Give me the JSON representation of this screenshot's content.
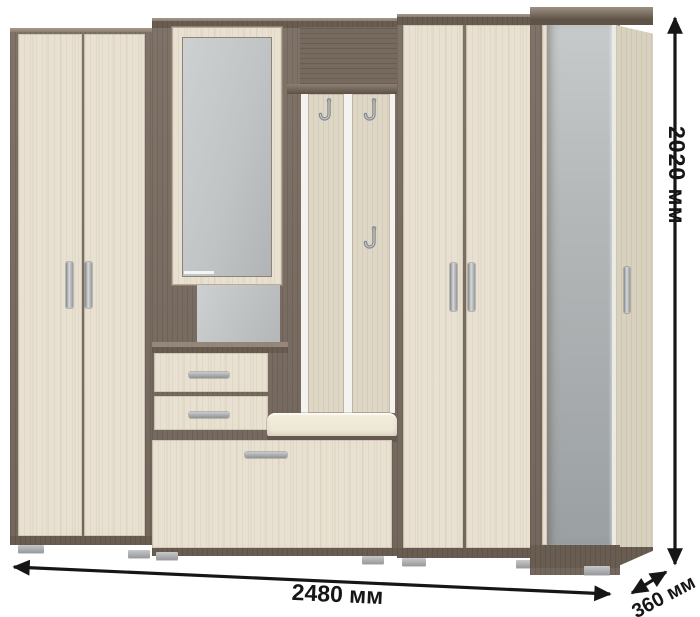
{
  "dimensions": {
    "width_label": "2480 мм",
    "height_label": "2020 мм",
    "depth_label": "360 мм"
  },
  "furniture": {
    "kind": "hallway furniture set",
    "sections": [
      {
        "name": "left wardrobe",
        "doors": 2,
        "handles": 2
      },
      {
        "name": "mirror cabinet with open shelf",
        "mirrors": 1
      },
      {
        "name": "drawer unit",
        "drawers": 2
      },
      {
        "name": "coat rack",
        "hooks": 3,
        "planks": 2
      },
      {
        "name": "bench with cushion",
        "cushions": 1
      },
      {
        "name": "shoe cabinet door",
        "doors": 1,
        "handles": 1
      },
      {
        "name": "right wardrobe",
        "doors": 2,
        "handles": 2
      },
      {
        "name": "tall mirror-door cabinet",
        "doors": 1,
        "handles": 1
      }
    ],
    "icons": {
      "coat_hook": "J-shaped metal hook",
      "door_handle": "vertical metal bar",
      "drawer_handle": "horizontal metal bow",
      "foot": "gray plastic block"
    }
  },
  "colors": {
    "wood_light": "#e8e1d1",
    "wood_plank": "#ded7c6",
    "wood_side": "#d8d1bf",
    "wood_dark": "#7a6d62",
    "wood_darker": "#695d52",
    "wood_deep": "#5a4f45",
    "mirror": "#bcc0c1",
    "metal": "#a9adb0",
    "cushion": "#ebe4d2",
    "strip": "#f5f3ef",
    "dim": "#161616",
    "bg": "#ffffff"
  }
}
